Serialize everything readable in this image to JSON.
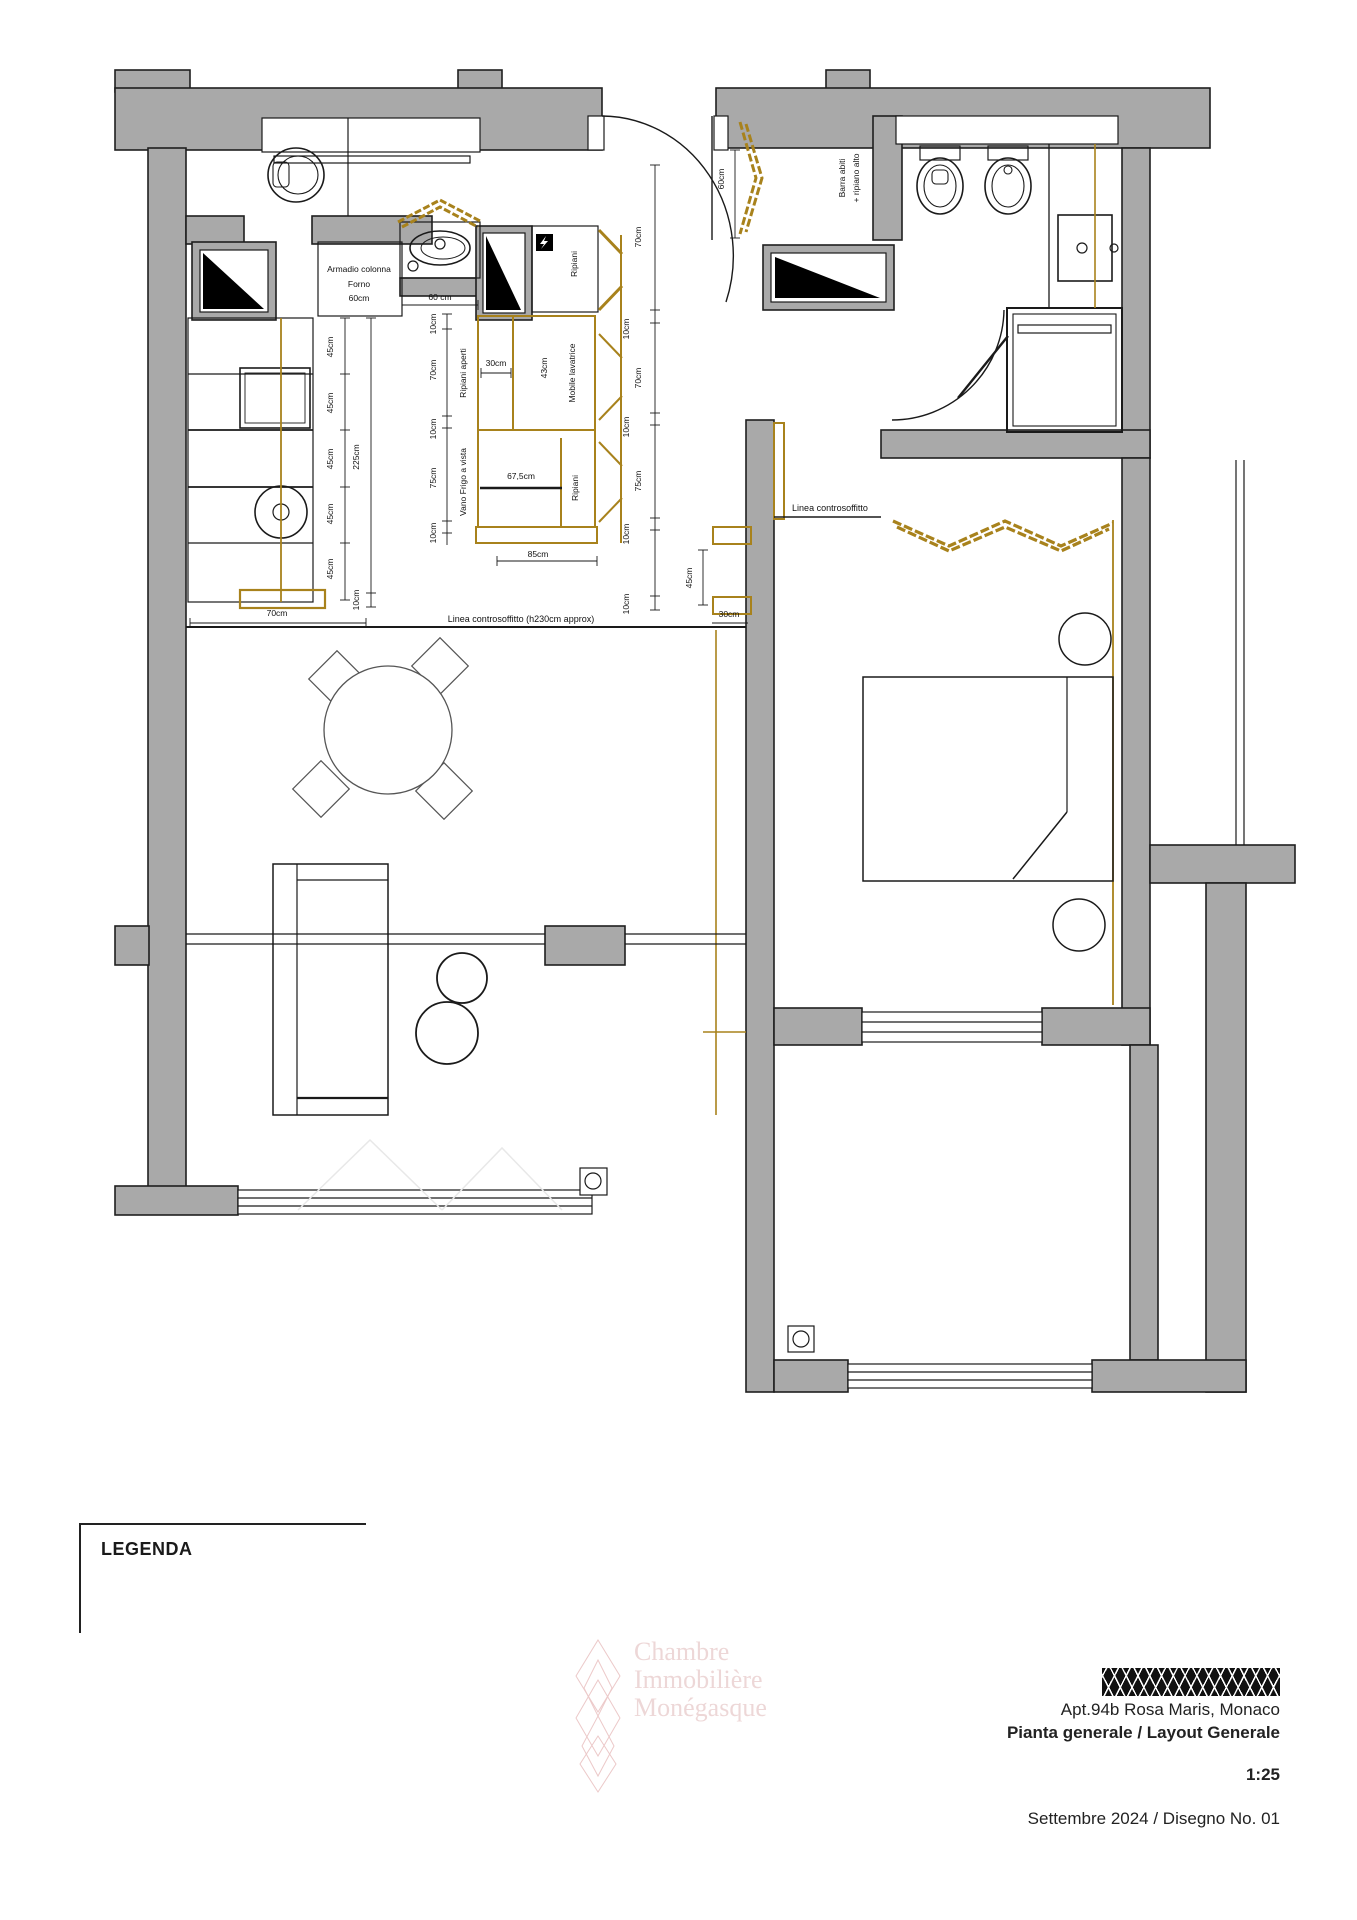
{
  "title_block": {
    "apartment": "Apt.94b Rosa Maris, Monaco",
    "drawing_title": "Pianta generale / Layout Generale",
    "scale": "1:25",
    "date_number": "Settembre 2024 / Disegno No. 01"
  },
  "legend": {
    "title": "LEGENDA"
  },
  "watermark": {
    "line1": "Chambre",
    "line2": "Immobilière",
    "line3": "Monégasque"
  },
  "colors": {
    "wall_gray": "#a9a9a9",
    "line_black": "#1a1a1a",
    "cabinet_gold": "#a8821c",
    "watermark_pink": "#d09696",
    "hatch_black": "#111111"
  },
  "floorplan": {
    "labels": [
      {
        "t": "Armadio colonna",
        "x": 359,
        "y": 272,
        "n": "label-armadio-colonna"
      },
      {
        "t": "Forno",
        "x": 359,
        "y": 287,
        "n": "label-forno"
      },
      {
        "t": "60cm",
        "x": 359,
        "y": 301,
        "n": "dim-armadio-60cm"
      },
      {
        "t": "60 cm",
        "x": 440,
        "y": 300,
        "n": "dim-sink-60cm"
      },
      {
        "t": "30cm",
        "x": 496,
        "y": 366,
        "n": "dim-ripiani-30cm"
      },
      {
        "t": "67,5cm",
        "x": 521,
        "y": 479,
        "n": "dim-frigo-67-5cm"
      },
      {
        "t": "85cm",
        "x": 538,
        "y": 557,
        "n": "dim-block-85cm"
      },
      {
        "t": "70cm",
        "x": 277,
        "y": 616,
        "n": "dim-counter-70cm"
      },
      {
        "t": "30cm",
        "x": 729,
        "y": 617,
        "n": "dim-wall-30cm"
      },
      {
        "t": "Linea controsoffitto (h230cm approx)",
        "x": 521,
        "y": 622,
        "s": 9,
        "n": "label-linea-controsoffitto-kitchen"
      },
      {
        "t": "Linea controsoffitto",
        "x": 830,
        "y": 511,
        "s": 9,
        "n": "label-linea-controsoffitto-bedroom"
      },
      {
        "t": "45cm",
        "x": 333,
        "y": 347,
        "r": -90,
        "n": "dim-45cm"
      },
      {
        "t": "45cm",
        "x": 333,
        "y": 403,
        "r": -90,
        "n": "dim-45cm"
      },
      {
        "t": "45cm",
        "x": 333,
        "y": 459,
        "r": -90,
        "n": "dim-45cm"
      },
      {
        "t": "45cm",
        "x": 333,
        "y": 514,
        "r": -90,
        "n": "dim-45cm"
      },
      {
        "t": "45cm",
        "x": 333,
        "y": 569,
        "r": -90,
        "n": "dim-45cm"
      },
      {
        "t": "225cm",
        "x": 359,
        "y": 457,
        "r": -90,
        "n": "dim-225cm"
      },
      {
        "t": "10cm",
        "x": 359,
        "y": 600,
        "r": -90,
        "n": "dim-10cm"
      },
      {
        "t": "10cm",
        "x": 436,
        "y": 324,
        "r": -90,
        "n": "dim-10cm"
      },
      {
        "t": "70cm",
        "x": 436,
        "y": 370,
        "r": -90,
        "n": "dim-70cm"
      },
      {
        "t": "10cm",
        "x": 436,
        "y": 429,
        "r": -90,
        "n": "dim-10cm"
      },
      {
        "t": "75cm",
        "x": 436,
        "y": 478,
        "r": -90,
        "n": "dim-75cm"
      },
      {
        "t": "10cm",
        "x": 436,
        "y": 533,
        "r": -90,
        "n": "dim-10cm"
      },
      {
        "t": "70cm",
        "x": 641,
        "y": 237,
        "r": -90,
        "n": "dim-70cm"
      },
      {
        "t": "10cm",
        "x": 629,
        "y": 329,
        "r": -90,
        "n": "dim-10cm"
      },
      {
        "t": "70cm",
        "x": 641,
        "y": 378,
        "r": -90,
        "n": "dim-70cm"
      },
      {
        "t": "10cm",
        "x": 629,
        "y": 427,
        "r": -90,
        "n": "dim-10cm"
      },
      {
        "t": "75cm",
        "x": 641,
        "y": 481,
        "r": -90,
        "n": "dim-75cm"
      },
      {
        "t": "10cm",
        "x": 629,
        "y": 534,
        "r": -90,
        "n": "dim-10cm"
      },
      {
        "t": "10cm",
        "x": 629,
        "y": 604,
        "r": -90,
        "n": "dim-10cm"
      },
      {
        "t": "60cm",
        "x": 724,
        "y": 179,
        "r": -90,
        "n": "dim-closet-60cm"
      },
      {
        "t": "45cm",
        "x": 692,
        "y": 578,
        "r": -90,
        "n": "dim-45cm"
      },
      {
        "t": "Ripiani",
        "x": 577,
        "y": 264,
        "r": -90,
        "n": "label-ripiani-top"
      },
      {
        "t": "Ripiani aperti",
        "x": 466,
        "y": 373,
        "r": -90,
        "n": "label-ripiani-aperti"
      },
      {
        "t": "43cm",
        "x": 547,
        "y": 368,
        "r": -90,
        "n": "dim-43cm"
      },
      {
        "t": "Mobile lavatrice",
        "x": 575,
        "y": 373,
        "r": -90,
        "n": "label-mobile-lavatrice"
      },
      {
        "t": "Vano Frigo a vista",
        "x": 466,
        "y": 482,
        "r": -90,
        "n": "label-vano-frigo"
      },
      {
        "t": "Ripiani",
        "x": 578,
        "y": 488,
        "r": -90,
        "n": "label-ripiani-bottom"
      },
      {
        "t": "Barra abiti",
        "x": 845,
        "y": 178,
        "r": -90,
        "n": "label-barra-abiti"
      },
      {
        "t": "+ ripiano alto",
        "x": 859,
        "y": 178,
        "r": -90,
        "n": "label-ripiano-alto"
      }
    ]
  }
}
